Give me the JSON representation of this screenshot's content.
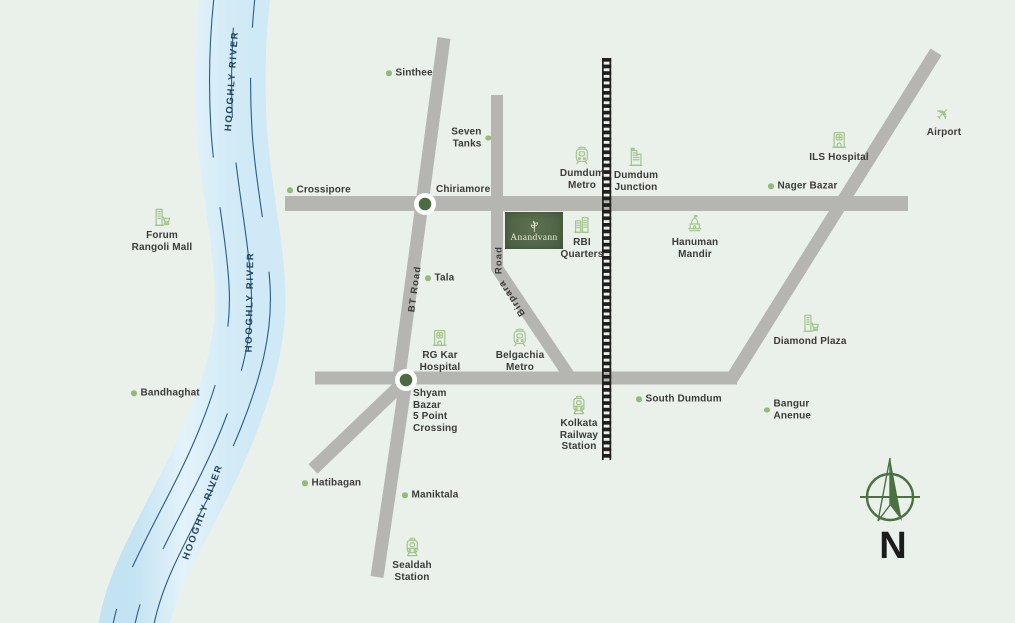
{
  "title": "Anandvann location map",
  "project": {
    "name": "Anandvann"
  },
  "compass": {
    "label": "N"
  },
  "river": {
    "label": "HOOGHLY RIVER"
  },
  "road_labels": {
    "bt_road": "BT Road",
    "birpara": "Birpara",
    "road_suffix": "Road"
  },
  "colors": {
    "bg": "#eaf0ea",
    "road": "#b5b6b1",
    "rail": "#1f1f1d",
    "label": "#3c3c3a",
    "dot": "#93bb78",
    "icon": "#a3c48c",
    "river_line": "#2a5c88",
    "river_text": "#25455e",
    "node": "#4d6b42",
    "compass": "#4b7141",
    "project_green_1": "#5d7251",
    "project_green_2": "#495d40",
    "project_text": "#ece8d2"
  },
  "locations": [
    {
      "id": "sinthee",
      "label": "Sinthee",
      "marker": "dot-left",
      "anchor": "lc",
      "x": 386,
      "y": 73
    },
    {
      "id": "seven-tanks",
      "label": "Seven\nTanks",
      "marker": "dot-right",
      "anchor": "rc",
      "align": "right",
      "x": 491,
      "y": 138
    },
    {
      "id": "crossipore",
      "label": "Crossipore",
      "marker": "dot-left",
      "anchor": "lc",
      "x": 287,
      "y": 190
    },
    {
      "id": "chiriamore",
      "label": "Chiriamore",
      "marker": "none",
      "anchor": "tl",
      "x": 436,
      "y": 184
    },
    {
      "id": "forum-rangoli-mall",
      "label": "Forum\nRangoli Mall",
      "marker": "icon",
      "icon": "mall",
      "anchor": "ct",
      "x": 162,
      "y": 206
    },
    {
      "id": "bandhaghat",
      "label": "Bandhaghat",
      "marker": "dot-left",
      "anchor": "lc",
      "x": 131,
      "y": 393
    },
    {
      "id": "dumdum-metro",
      "label": "Dumdum\nMetro",
      "marker": "icon",
      "icon": "metro",
      "anchor": "ct",
      "x": 582,
      "y": 144
    },
    {
      "id": "dumdum-junction",
      "label": "Dumdum\nJunction",
      "marker": "icon",
      "icon": "junction",
      "anchor": "ct",
      "x": 636,
      "y": 146
    },
    {
      "id": "ils-hospital",
      "label": "ILS Hospital",
      "marker": "icon",
      "icon": "hospital",
      "anchor": "ct",
      "x": 839,
      "y": 128
    },
    {
      "id": "airport",
      "label": "Airport",
      "marker": "icon",
      "icon": "plane",
      "anchor": "ct",
      "x": 944,
      "y": 103
    },
    {
      "id": "nager-bazar",
      "label": "Nager Bazar",
      "marker": "dot-left",
      "anchor": "lc",
      "x": 768,
      "y": 186
    },
    {
      "id": "rbi-quarters",
      "label": "RBI\nQuarters",
      "marker": "icon",
      "icon": "buildings",
      "anchor": "ct",
      "x": 582,
      "y": 213
    },
    {
      "id": "hanuman-mandir",
      "label": "Hanuman\nMandir",
      "marker": "icon",
      "icon": "temple",
      "anchor": "ct",
      "x": 695,
      "y": 213
    },
    {
      "id": "tala",
      "label": "Tala",
      "marker": "dot-left",
      "anchor": "lc",
      "x": 425,
      "y": 278
    },
    {
      "id": "rg-kar-hospital",
      "label": "RG Kar\nHospital",
      "marker": "icon",
      "icon": "hospital",
      "anchor": "ct",
      "x": 440,
      "y": 326
    },
    {
      "id": "belgachia-metro",
      "label": "Belgachia\nMetro",
      "marker": "icon",
      "icon": "metro",
      "anchor": "ct",
      "x": 520,
      "y": 326
    },
    {
      "id": "shyam-bazar-5-point-crossing",
      "label": "Shyam\nBazar\n5 Point\nCrossing",
      "marker": "none",
      "anchor": "tl",
      "x": 413,
      "y": 388
    },
    {
      "id": "hatibagan",
      "label": "Hatibagan",
      "marker": "dot-left",
      "anchor": "lc",
      "x": 302,
      "y": 483
    },
    {
      "id": "maniktala",
      "label": "Maniktala",
      "marker": "dot-left",
      "anchor": "lc",
      "x": 402,
      "y": 495
    },
    {
      "id": "sealdah-station",
      "label": "Sealdah\nStation",
      "marker": "icon",
      "icon": "train",
      "anchor": "ct",
      "x": 412,
      "y": 536
    },
    {
      "id": "kolkata-railway-station",
      "label": "Kolkata\nRailway\nStation",
      "marker": "icon",
      "icon": "train",
      "anchor": "ct",
      "x": 579,
      "y": 394
    },
    {
      "id": "south-dumdum",
      "label": "South Dumdum",
      "marker": "dot-left",
      "anchor": "lc",
      "x": 636,
      "y": 399
    },
    {
      "id": "bangur-anenue",
      "label": "Bangur\nAnenue",
      "marker": "dot-left",
      "anchor": "lc",
      "x": 764,
      "y": 410
    },
    {
      "id": "diamond-plaza",
      "label": "Diamond Plaza",
      "marker": "icon",
      "icon": "mall",
      "anchor": "ct",
      "x": 810,
      "y": 312
    }
  ]
}
